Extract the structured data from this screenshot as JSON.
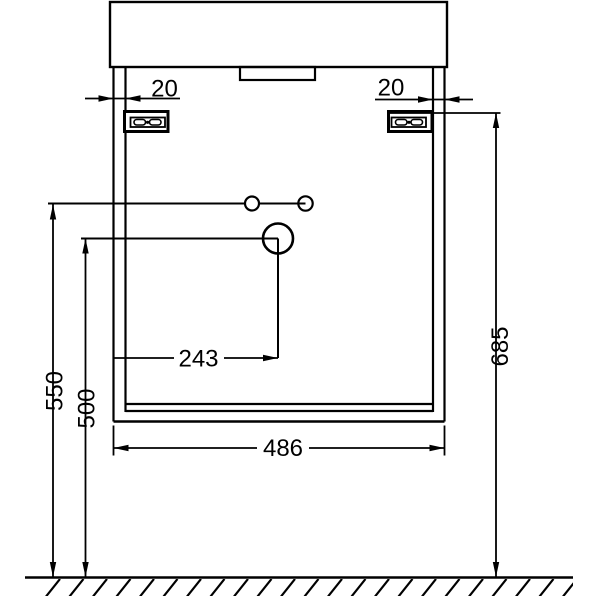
{
  "drawing": {
    "type": "technical-dimension-diagram",
    "subject": "wall-hung vanity unit with washbasin, front elevation",
    "units_shown": "mm",
    "colors": {
      "line": "#000000",
      "background": "#ffffff"
    }
  },
  "dims": {
    "d20_left": "20",
    "d20_right": "20",
    "d243": "243",
    "d486": "486",
    "d500": "500",
    "d550": "550",
    "d685": "685"
  }
}
